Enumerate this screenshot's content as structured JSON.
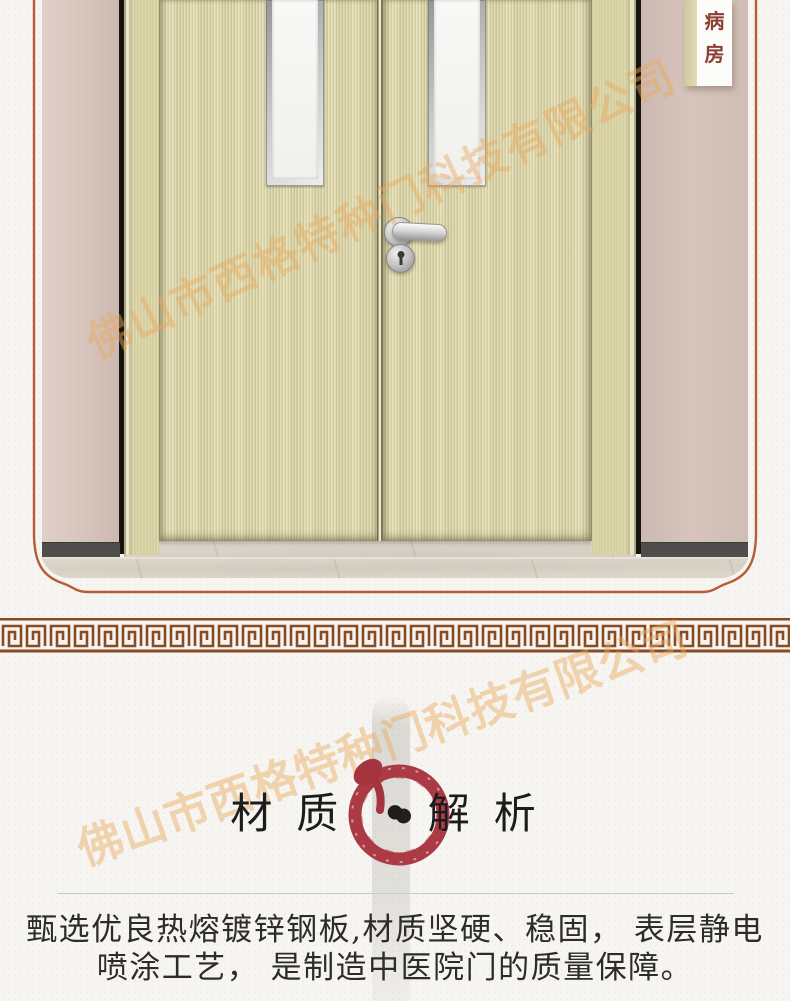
{
  "photo": {
    "ward_sign": {
      "char1": "病",
      "char2": "房"
    },
    "watermark_text": "佛山市西格特种门科技有限公司"
  },
  "material_section": {
    "title_left": "材质",
    "separator": "•",
    "title_right": "解析",
    "watermark_text": "佛山市西格特种门科技有限公司",
    "body_line1": "甄选优良热熔镀锌钢板,材质坚硬、稳固， 表层静电",
    "body_line2": "喷涂工艺， 是制造中医院门的质量保障。"
  },
  "colors": {
    "frame_line": "#b85c35",
    "meander_brown": "#8a4a22",
    "enso_red": "#ac3a44",
    "door_leaf": "#ded7a9",
    "wall_pink": "#d6c3bb",
    "sign_text": "#8d3e33",
    "watermark_orange": "rgba(232,168,90,0.45)"
  }
}
